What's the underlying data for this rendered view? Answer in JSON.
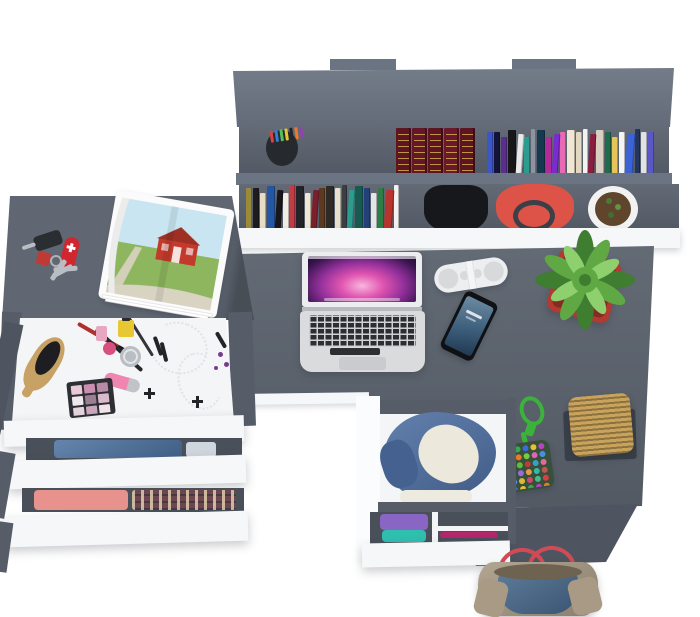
{
  "scene": {
    "description": "Top-down 3D render of a dark gray student desk set: wall book shelf, L-shaped desk with laptop, pill speaker, smartphone and potted plant, side dresser with open drawers full of makeup and folded clothes, clothes drawer under the desk, wicker basket, bead charm and a denim tote bag on the floor",
    "background": "#ffffff"
  },
  "palette": {
    "desk_surface": "#59616c",
    "desk_side": "#4e5560",
    "shelf_top": "#6b7482",
    "shelf_interior": "#59616d",
    "shelf_lip": "#6b7482",
    "rail_gray": "#565d68",
    "slot_gray": "#4a505a",
    "white_front": "#f6f7f9",
    "drawer_interior": "#f4f5f6"
  },
  "shelf": {
    "pen_cup": {
      "cup": "#26292e",
      "pens": [
        "#d84343",
        "#3a7bd5",
        "#58c05a",
        "#e8c832",
        "#23252a",
        "#e87a2a",
        "#8e44ad"
      ]
    },
    "encyclopedia_spines": [
      "#5d1423",
      "#64172b",
      "#5d1423",
      "#6a182d",
      "#5d1423"
    ],
    "gilt": "#c9a445",
    "upper_books": [
      "#3a56c8",
      "#14143a",
      "#5b2d8e",
      "#17171a",
      "#e9e9ea",
      "#2a9d8f",
      "#8d93a0",
      "#15394f",
      "#b02a9a",
      "#7b2bd0",
      "#e86ab2",
      "#efe6d3",
      "#e3d8c2",
      "#f2f2f2",
      "#8b1e3f",
      "#d8cfc0",
      "#1f6b4a",
      "#e6c45a",
      "#f4f4f4",
      "#3a63d8",
      "#24355e",
      "#dfe2e6",
      "#5a57c8"
    ],
    "lower_books": [
      "#9a8a3a",
      "#1c1c1f",
      "#e7dcc6",
      "#2456a4",
      "#17171a",
      "#f1ede4",
      "#c23b45",
      "#23232a",
      "#efe7d2",
      "#7a1f2b",
      "#5c3a21",
      "#2f2a26",
      "#e8e0cf",
      "#3a3f45",
      "#2a9d8f",
      "#175a52",
      "#23407a",
      "#e4e6e8",
      "#2f7d46",
      "#b8342c",
      "#f2f2f2"
    ],
    "backpack": "#17181b",
    "handbag": {
      "body": "#de5347",
      "strap": "#3b4048"
    },
    "planter": {
      "pot": "#f2f2f2",
      "soil": "#5e452c"
    }
  },
  "desk": {
    "laptop": {
      "shell": "#d9dbdd",
      "keys": "#2c2e31",
      "trackpad": "#c9cbcd",
      "hinge": "#b7babd",
      "lid": "#ebedee"
    },
    "speaker": {
      "body": "#eceeef",
      "grille": "#d7d9db",
      "band": "#f4f5f6"
    },
    "phone": {
      "body": "#101114"
    },
    "plant": {
      "pot": "#b23a30",
      "leaf_dark": "#3f7d31",
      "leaf_mid": "#5fa844",
      "leaf_light": "#8ecf6e"
    },
    "basket": {
      "weave_light": "#c9a35c",
      "tray": "#3a4049"
    },
    "bead_charm": {
      "cord": "#3bb33b",
      "pouch": "#37503a",
      "beads": [
        "#d94040",
        "#3aa655",
        "#3a6bd9",
        "#e8c22e",
        "#b544c0",
        "#2ab9c9",
        "#e87a2a",
        "#7ac943",
        "#d966b8",
        "#4a8de0",
        "#e8a02e",
        "#5bbf3a",
        "#c23a3a",
        "#3a9ec9",
        "#e06a9e",
        "#57c957",
        "#9a6ae0",
        "#e89a4a",
        "#35b8a8",
        "#c05555",
        "#6a8ae8",
        "#d9b83a",
        "#c94a6a",
        "#4ab88a",
        "#d94040",
        "#3a6bd9",
        "#e8c22e",
        "#3aa655",
        "#b544c0",
        "#e87a2a"
      ]
    }
  },
  "side_table": {
    "car_key_fob": "#2a2d31",
    "key_blade": "#b9bec4",
    "pocket_knife": "#cf2630",
    "keychain_fob": "#c03a35",
    "magazine": {
      "page": "#fbfbfb",
      "sky": "#c9e5f1",
      "grass": "#8db65e",
      "barn": "#c23a2c",
      "roof": "#9e2f24",
      "path": "#d9d3c2"
    }
  },
  "makeup_drawer": {
    "hairbrush_handle": "#c8a165",
    "hairbrush_bristles": "#1e1e22",
    "brush_red": "#b03030",
    "brush_black": "#26272b",
    "eyeliner": "#33353a",
    "perfume_pink": "#e8a7c0",
    "perfume_round": "#d94f7e",
    "nail_polish": "#e8c832",
    "jar": "#b9bec4",
    "lipgloss_body": "#ef86b2",
    "lipgloss_cap": "#c0c4c8",
    "palette_case": "#2e2f34",
    "palette_shades": [
      "#e9c9d6",
      "#c98fae",
      "#b98aa6",
      "#efe8ec",
      "#9b7f92",
      "#d9b9cb",
      "#e3d3dd",
      "#caa6bd",
      "#f0e4ea"
    ],
    "clip_black": "#222428",
    "earring_purple": "#7a3b8f"
  },
  "clothes": {
    "denim_folded": "#4f74a2",
    "light_shirt": "#cfd6de",
    "pink_shirt": "#e8928e",
    "plaid_base": "#6e4650",
    "jacket_denim": "#4e6fa3",
    "jacket_sleeve": "#44618f",
    "jacket_fleece": "#ece9dc",
    "white_cloth": "#edebdf",
    "purple_shirt": "#8a66c4",
    "teal_shirt": "#2fbfae",
    "magenta_cloth": "#b5266a"
  },
  "tote": {
    "canvas": "#a89a84",
    "denim": "#47688c",
    "handles": "#d14b57",
    "opening": "#6e6350"
  }
}
